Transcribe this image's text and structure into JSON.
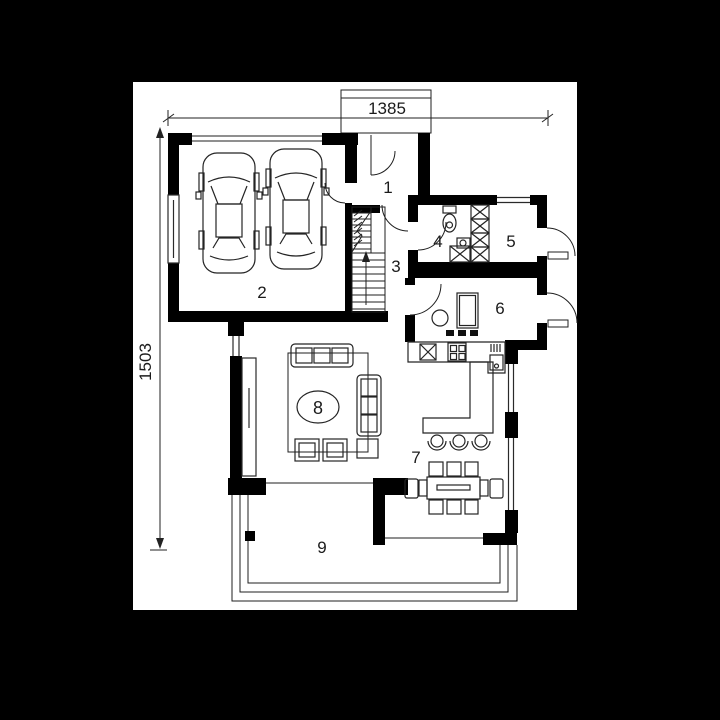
{
  "colors": {
    "background": "#000000",
    "canvas": "#ffffff",
    "ink": "#1b1b1b"
  },
  "dimensions": {
    "top_width": "1385",
    "left_height": "1503"
  },
  "rooms": [
    {
      "number": "1"
    },
    {
      "number": "2"
    },
    {
      "number": "3"
    },
    {
      "number": "4"
    },
    {
      "number": "5"
    },
    {
      "number": "6"
    },
    {
      "number": "7"
    },
    {
      "number": "8"
    },
    {
      "number": "9"
    }
  ],
  "symbols": [
    "car-icon",
    "staircase-icon",
    "up-arrow-icon",
    "toilet-icon",
    "washbasin-icon",
    "shower-box-icon",
    "wardrobe-x-icon",
    "kitchen-table-icon",
    "stool-icon",
    "fridge-x-icon",
    "stove-icon",
    "kitchen-sink-icon",
    "bar-counter-icon",
    "bar-stool-icon",
    "dining-table-icon",
    "dining-chair-icon",
    "sofa-icon",
    "armchair-icon",
    "side-table-icon",
    "coffee-table-icon",
    "rug-icon",
    "window-icon",
    "door-arc-icon",
    "dimension-arrow-icon",
    "terrace-deck-icon"
  ]
}
